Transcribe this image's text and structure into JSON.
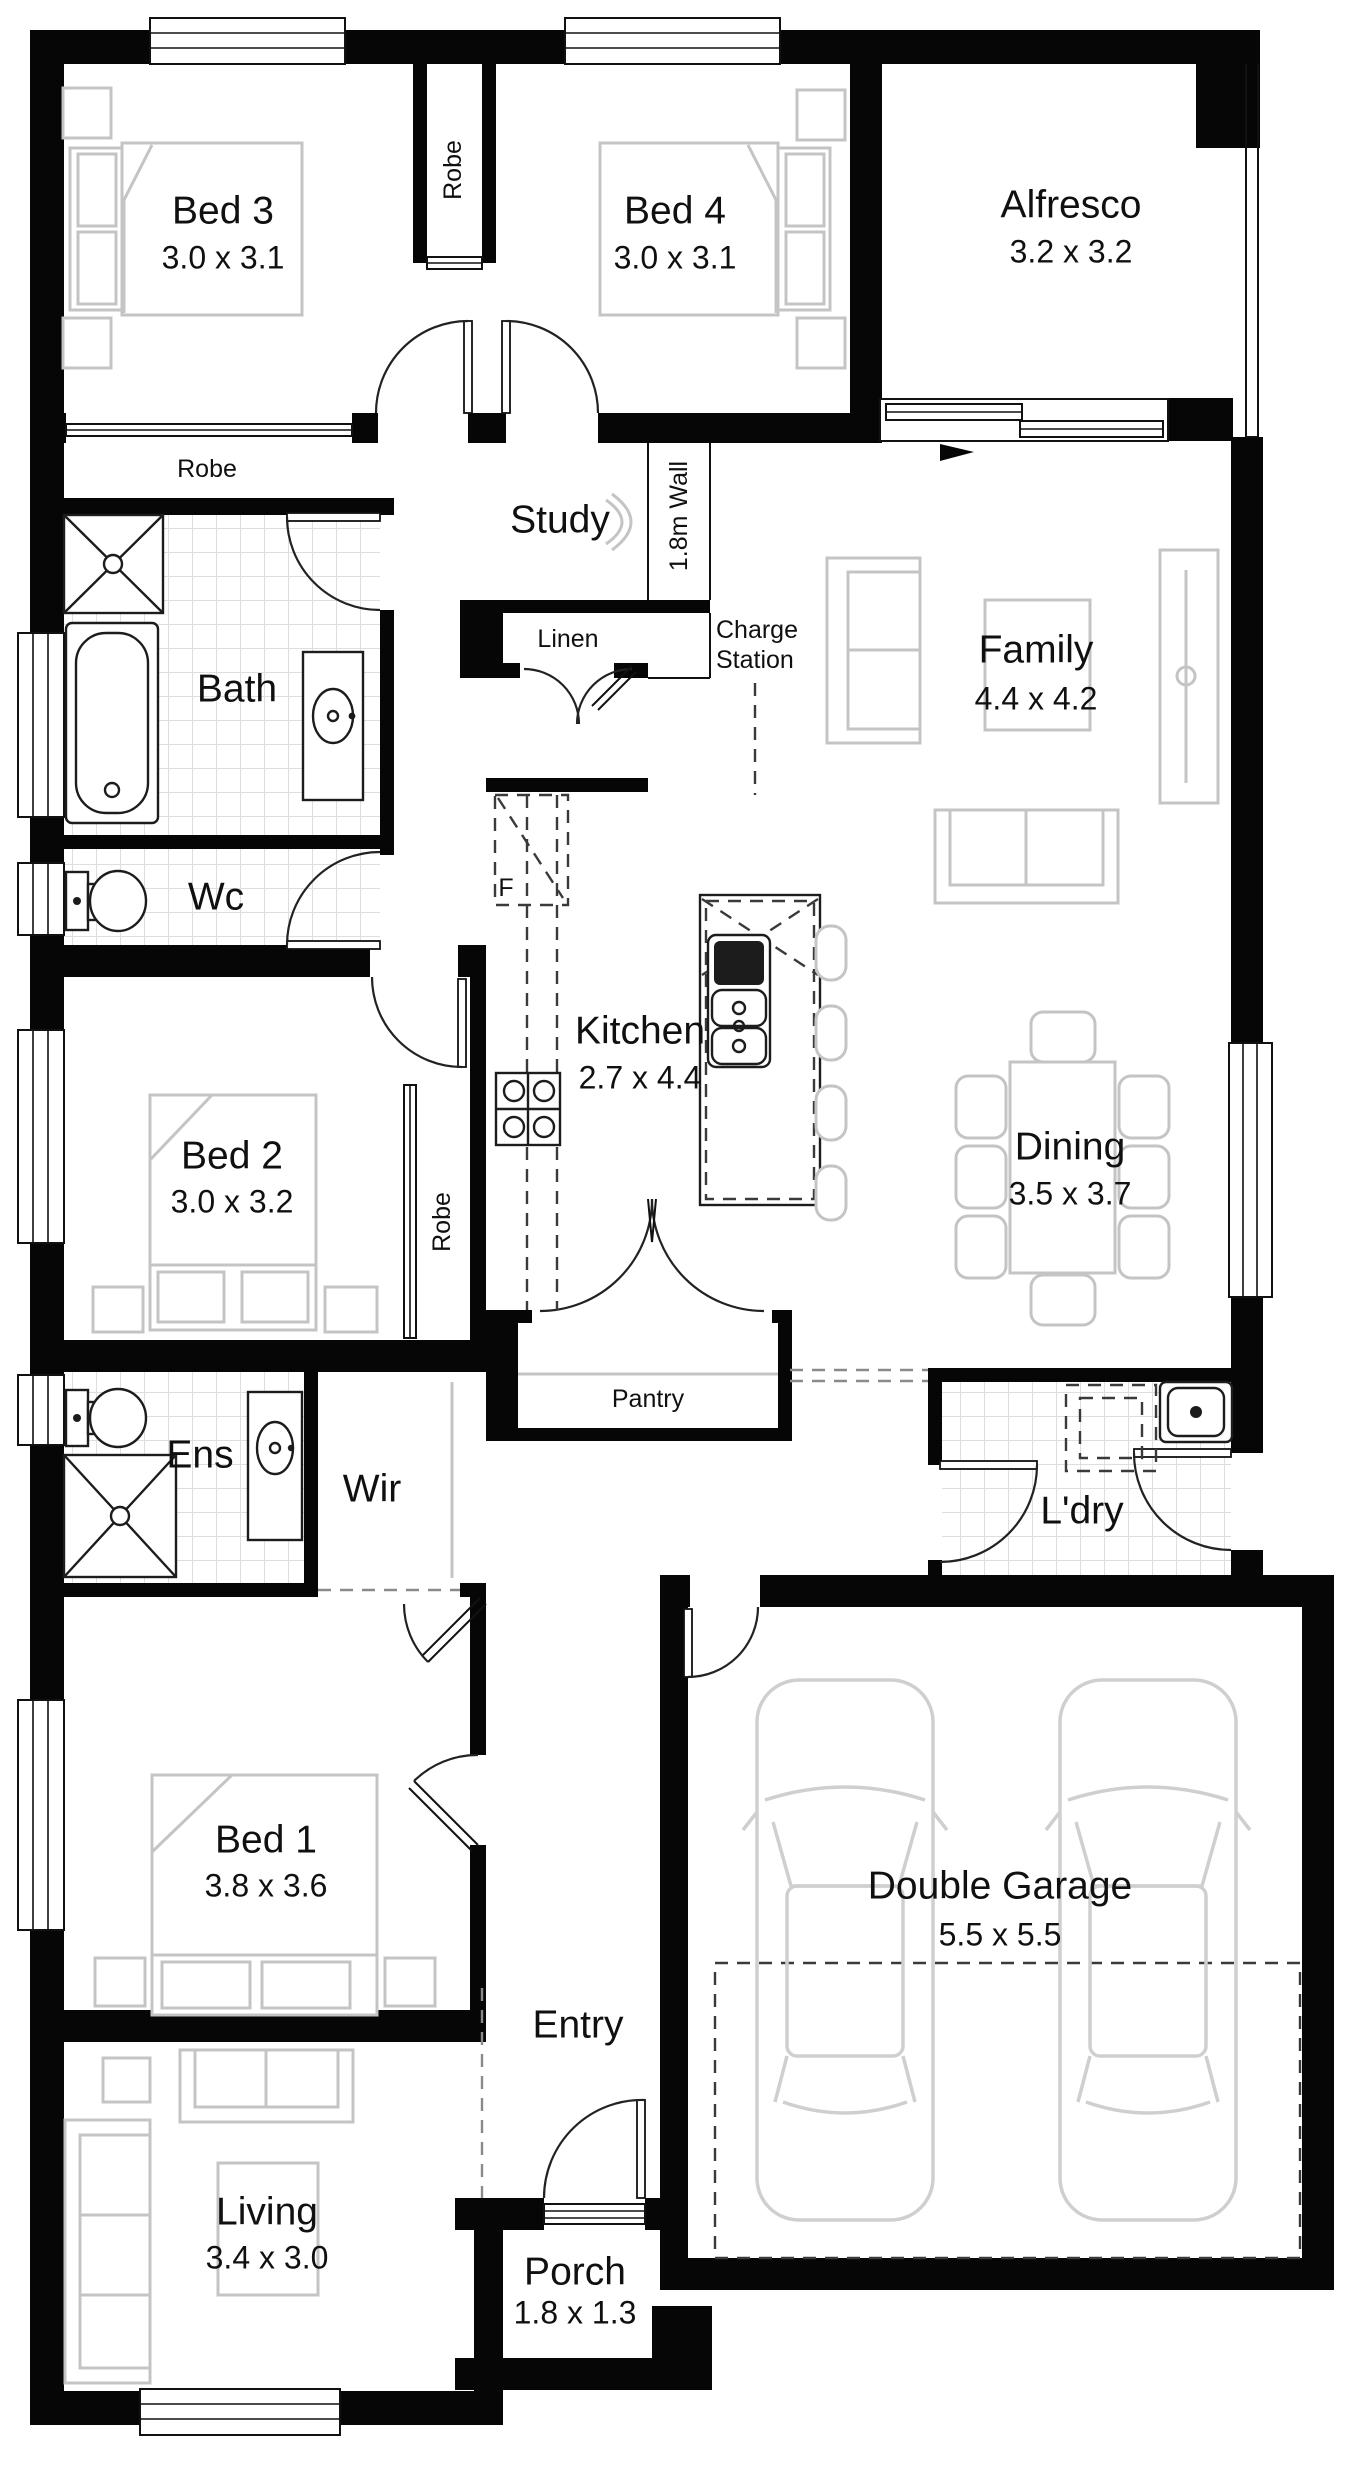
{
  "plan": {
    "rooms": {
      "bed3": {
        "name": "Bed 3",
        "dims": "3.0 x 3.1"
      },
      "bed4": {
        "name": "Bed 4",
        "dims": "3.0 x 3.1"
      },
      "alfresco": {
        "name": "Alfresco",
        "dims": "3.2 x 3.2"
      },
      "study": {
        "name": "Study"
      },
      "family": {
        "name": "Family",
        "dims": "4.4 x 4.2"
      },
      "bath": {
        "name": "Bath"
      },
      "wc": {
        "name": "Wc"
      },
      "kitchen": {
        "name": "Kitchen",
        "dims": "2.7 x 4.4"
      },
      "dining": {
        "name": "Dining",
        "dims": "3.5 x 3.7"
      },
      "bed2": {
        "name": "Bed 2",
        "dims": "3.0 x 3.2"
      },
      "pantry": {
        "name": "Pantry"
      },
      "ens": {
        "name": "Ens"
      },
      "wir": {
        "name": "Wir"
      },
      "ldry": {
        "name": "L'dry"
      },
      "bed1": {
        "name": "Bed 1",
        "dims": "3.8 x 3.6"
      },
      "garage": {
        "name": "Double Garage",
        "dims": "5.5 x 5.5"
      },
      "entry": {
        "name": "Entry"
      },
      "living": {
        "name": "Living",
        "dims": "3.4 x 3.0"
      },
      "porch": {
        "name": "Porch",
        "dims": "1.8 x 1.3"
      },
      "linen": {
        "name": "Linen"
      }
    },
    "annotations": {
      "robe_corridor": "Robe",
      "robe_bed3": "Robe",
      "robe_bed2": "Robe",
      "wall_1_8m": "1.8m Wall",
      "charge_line1": "Charge",
      "charge_line2": "Station",
      "fridge": "F"
    },
    "colors": {
      "wall": "#060606",
      "furniture": "#c4c4c4",
      "tile": "#dedede",
      "text": "#101010"
    }
  }
}
